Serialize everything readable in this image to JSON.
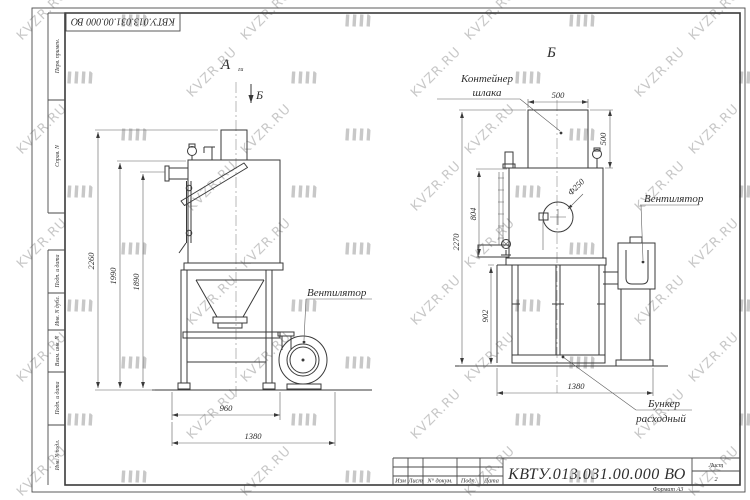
{
  "sheet": {
    "stamp_top": "КВТУ.013.031.00.000  ВО",
    "format_note": "Формат А3",
    "side_labels": [
      "Перв. примен.",
      "Справ. N",
      "Подп. и дата",
      "Инв. N дубл.",
      "Взам. инв. N",
      "Подп. и дата",
      "Инв. N подл."
    ]
  },
  "title_block": {
    "doc_number": "КВТУ.013.031.00.000  ВО",
    "columns": [
      "Изм",
      "Лист",
      "N° докум.",
      "Подп.",
      "Дата"
    ],
    "sheet_label": "Лист",
    "sheet_value": "2"
  },
  "views": {
    "left": {
      "title": "А",
      "title_sub": "ги",
      "section_mark": "Б",
      "fan_label": "Вентилятор",
      "dims": {
        "height_total": "2260",
        "height_body": "1990",
        "height_nozzle": "1890",
        "width_frame": "960",
        "width_total": "1380"
      }
    },
    "right": {
      "title": "Б",
      "container_label": [
        "Контейнер",
        "шлака"
      ],
      "fan_label": "Вентилятор",
      "hopper_label": [
        "Бункер",
        "расходный"
      ],
      "dims": {
        "container_width": "500",
        "container_height": "500",
        "port_diameter": "Ф250",
        "body_height": "804",
        "total_height": "2270",
        "frame_height": "902",
        "width_total": "1380"
      }
    }
  },
  "watermark": {
    "text": "KVZR.RU",
    "color": "#c8c8c8"
  }
}
